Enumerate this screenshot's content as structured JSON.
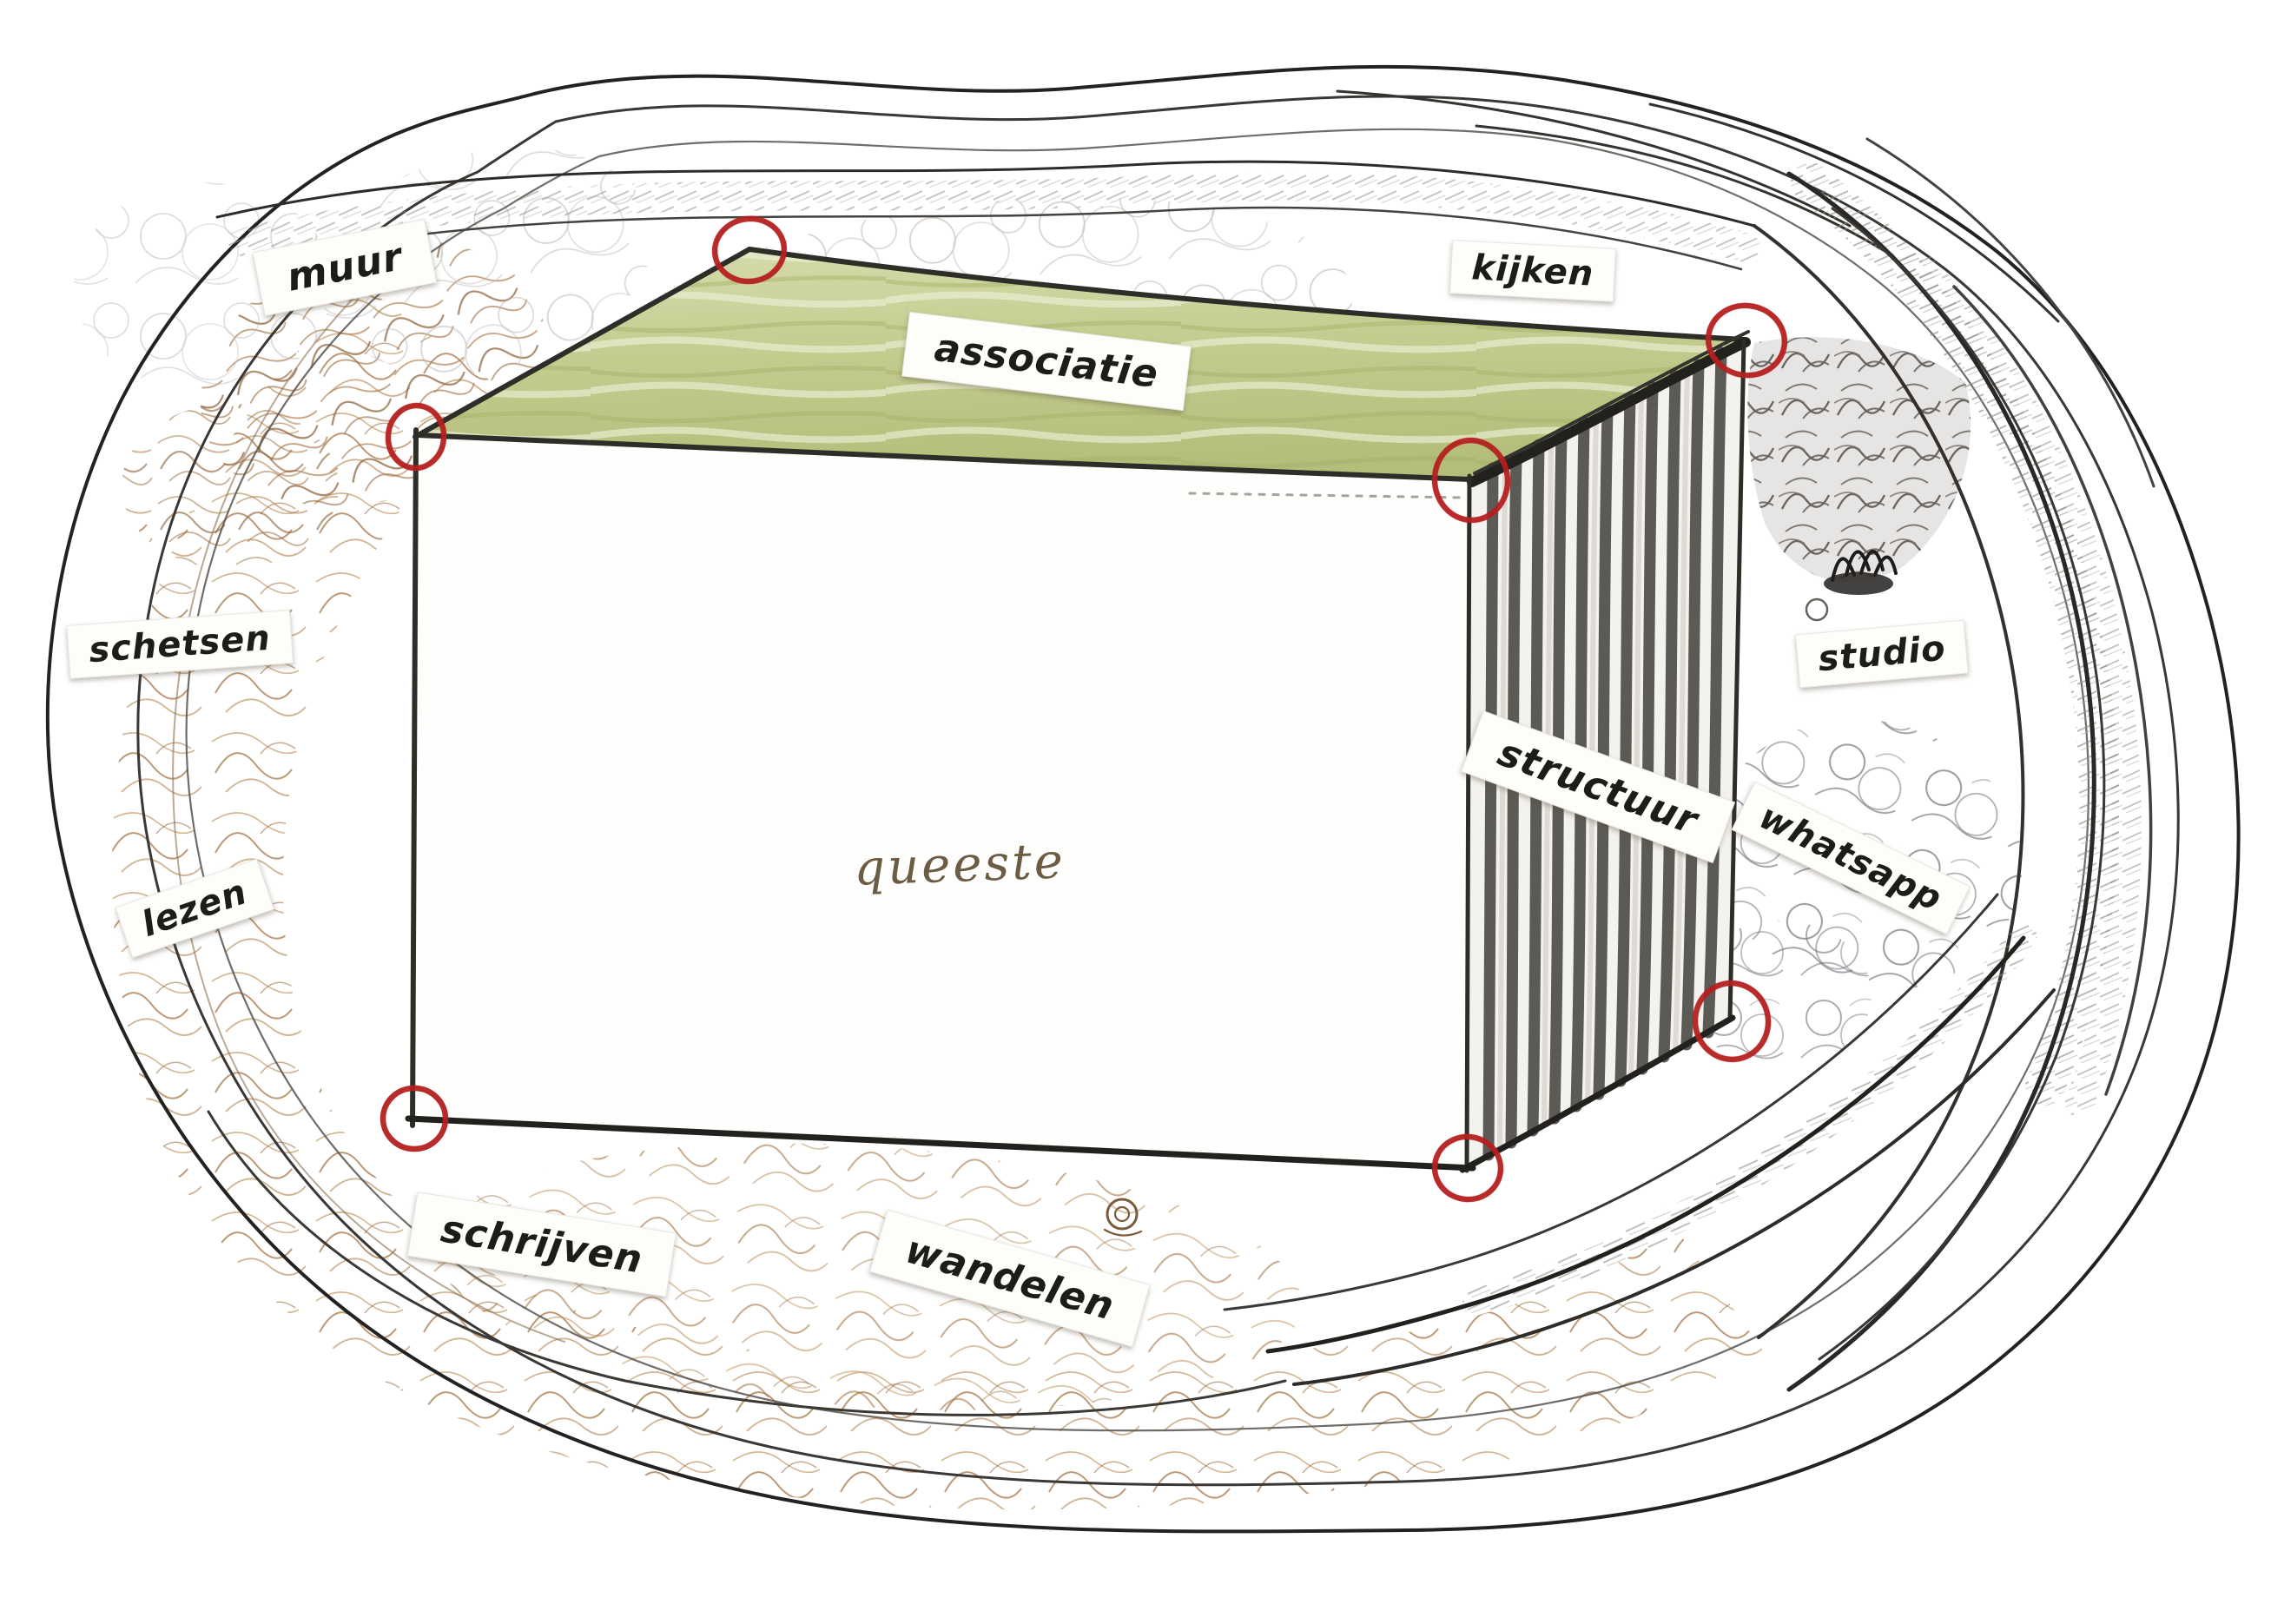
{
  "artwork": {
    "type": "hand-drawn mind map sketch of a perspective room inside an organic cave-like pencil border",
    "center_word": {
      "text": "queeste"
    },
    "labels": [
      {
        "id": "muur",
        "text": "muur"
      },
      {
        "id": "kijken",
        "text": "kijken"
      },
      {
        "id": "associatie",
        "text": "associatie"
      },
      {
        "id": "schetsen",
        "text": "schetsen"
      },
      {
        "id": "lezen",
        "text": "lezen"
      },
      {
        "id": "structuur",
        "text": "structuur"
      },
      {
        "id": "studio",
        "text": "studio"
      },
      {
        "id": "whatsapp",
        "text": "whatsapp"
      },
      {
        "id": "schrijven",
        "text": "schrijven"
      },
      {
        "id": "wandelen",
        "text": "wandelen"
      }
    ],
    "colors": {
      "paper": "#ffffff",
      "ink": "#1d1c1a",
      "red_marker": "#b5201f",
      "green_top": "#c2ca8e",
      "sepia_shading": "#a67c4e",
      "graphite": "#4a4744",
      "stripe_dark": "#504e49",
      "label_paper": "#fdfdfa",
      "queeste_ink": "#6d5c44"
    },
    "corner_marker_count": 7
  }
}
